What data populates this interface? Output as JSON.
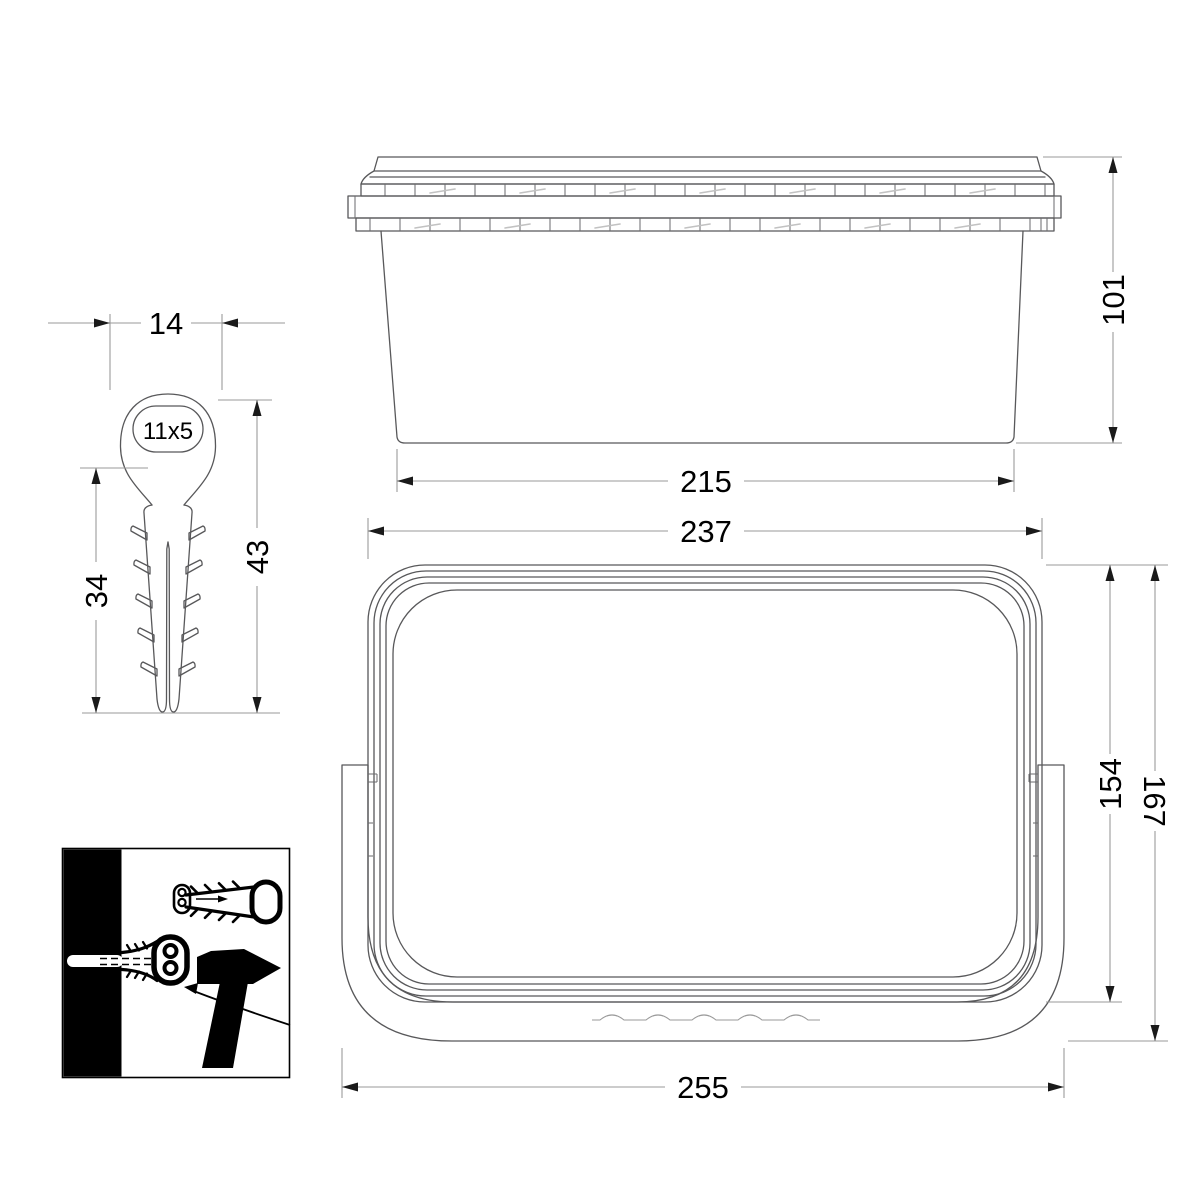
{
  "drawing_title": "container-with-lid-and-nail-plug-technical-drawing",
  "views": {
    "side": {
      "height_mm": "101",
      "base_width_mm": "215"
    },
    "plan": {
      "lid_width_mm": "237",
      "lid_depth_mm": "154",
      "overall_depth_mm": "167",
      "overall_width_mm": "255"
    },
    "plug": {
      "head_width_mm": "14",
      "hole_size_mm": "11x5",
      "shank_length_mm": "34",
      "overall_length_mm": "43"
    }
  },
  "colors": {
    "background": "#ffffff",
    "outline": "#58585a",
    "dimension_line": "#9a9a9a",
    "dimension_text": "#000000",
    "pictogram": "#000000"
  }
}
